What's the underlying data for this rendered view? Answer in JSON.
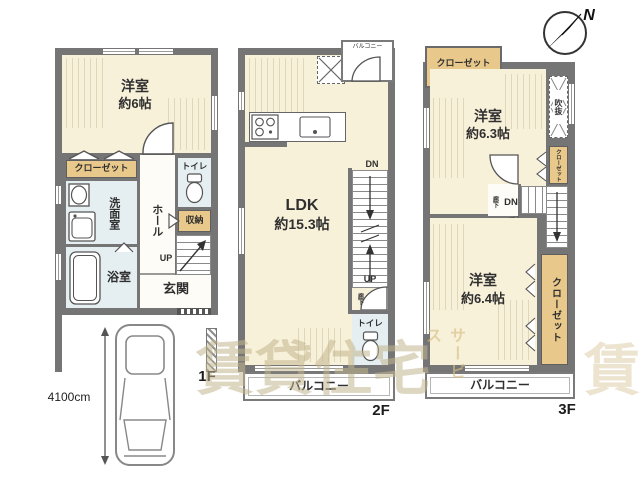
{
  "compass": {
    "north": "N"
  },
  "watermark": {
    "main": "賃貸住宅",
    "sub": "サービス",
    "tile": "賃"
  },
  "parking": {
    "length_label": "4100cm"
  },
  "floor1": {
    "label": "1F",
    "room_name": "洋室",
    "room_size": "約6帖",
    "closet": "クローゼット",
    "washroom": "洗面室",
    "hall": "ホール",
    "toilet": "トイレ",
    "storage": "収納",
    "bath": "浴室",
    "entrance": "玄関",
    "up": "UP"
  },
  "floor2": {
    "label": "2F",
    "ldk_name": "LDK",
    "ldk_size": "約15.3帖",
    "balcony_small": "バルコニー",
    "dn": "DN",
    "up": "UP",
    "hallway": "廊下",
    "toilet": "トイレ",
    "balcony": "バルコニー"
  },
  "floor3": {
    "label": "3F",
    "closet_top": "クローゼット",
    "room1_name": "洋室",
    "room1_size": "約6.3帖",
    "void": "吹抜",
    "closet_mid": "クローゼット",
    "hallway": "廊下",
    "dn": "DN",
    "room2_name": "洋室",
    "room2_size": "約6.4帖",
    "closet_right": "クローゼット",
    "balcony": "バルコニー"
  },
  "colors": {
    "wall": "#757575",
    "room_cream": "#f8f1da",
    "wet_blue": "#e5eef0",
    "closet_tan": "#e9c98b"
  }
}
